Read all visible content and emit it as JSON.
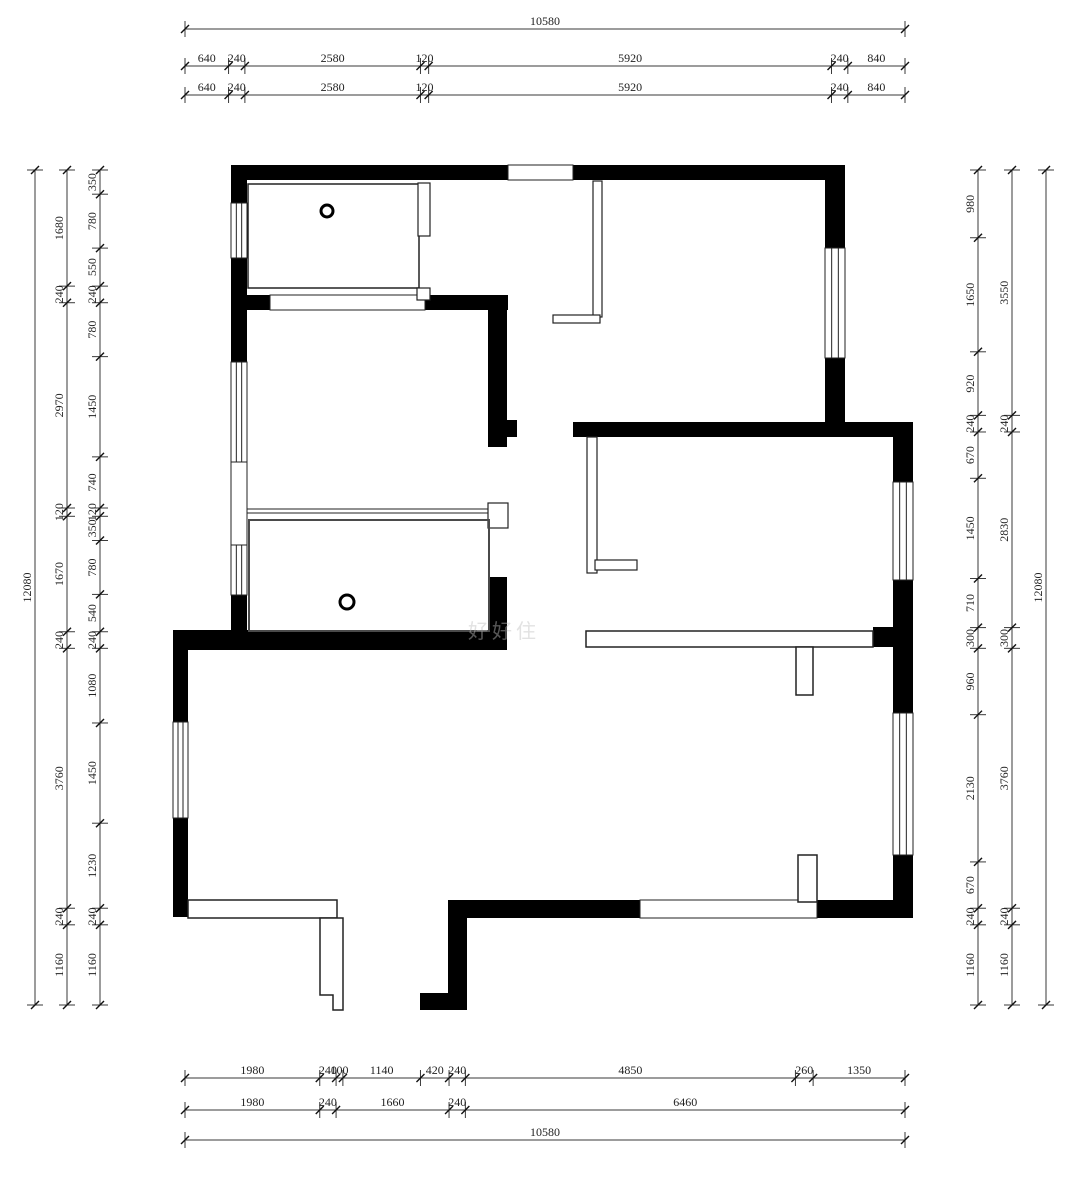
{
  "drawing": {
    "type": "architectural-floor-plan",
    "canvas": {
      "w": 1080,
      "h": 1178
    },
    "colors": {
      "wall": "#000000",
      "dim_line": "#3a3a3a",
      "dim_text": "#222222",
      "thin_line": "#222222",
      "room_outline": "#4a4a4a",
      "background": "#ffffff"
    },
    "watermark": {
      "text": "好好住"
    },
    "dim_font_size": 12,
    "dim_chains": [
      {
        "id": "top-overall",
        "orientation": "h",
        "line": 29,
        "start": 185,
        "end": 905,
        "segments": [
          10580
        ]
      },
      {
        "id": "top-row-1",
        "orientation": "h",
        "line": 66,
        "start": 185,
        "end": 905,
        "segments": [
          640,
          240,
          2580,
          120,
          5920,
          240,
          840
        ]
      },
      {
        "id": "top-row-2",
        "orientation": "h",
        "line": 95,
        "start": 185,
        "end": 905,
        "segments": [
          640,
          240,
          2580,
          120,
          5920,
          240,
          840
        ]
      },
      {
        "id": "left-outer",
        "orientation": "v",
        "line": 35,
        "start": 170,
        "end": 1005,
        "segments": [
          12080
        ]
      },
      {
        "id": "left-middle",
        "orientation": "v",
        "line": 67,
        "start": 170,
        "end": 1005,
        "segments": [
          1680,
          240,
          2970,
          120,
          1670,
          240,
          3760,
          240,
          1160
        ]
      },
      {
        "id": "left-inner",
        "orientation": "v",
        "line": 100,
        "start": 170,
        "end": 1005,
        "segments": [
          350,
          780,
          550,
          240,
          780,
          1450,
          740,
          120,
          350,
          780,
          540,
          240,
          1080,
          1450,
          1230,
          240,
          1160
        ]
      },
      {
        "id": "right-inner",
        "orientation": "v",
        "line": 978,
        "start": 170,
        "end": 1005,
        "segments": [
          980,
          1650,
          920,
          240,
          670,
          1450,
          710,
          300,
          960,
          2130,
          670,
          240,
          1160
        ]
      },
      {
        "id": "right-middle",
        "orientation": "v",
        "line": 1012,
        "start": 170,
        "end": 1005,
        "segments": [
          3550,
          240,
          2830,
          300,
          3760,
          240,
          1160
        ]
      },
      {
        "id": "right-outer",
        "orientation": "v",
        "line": 1046,
        "start": 170,
        "end": 1005,
        "segments": [
          12080
        ]
      },
      {
        "id": "bottom-row-1",
        "orientation": "h",
        "line": 1078,
        "start": 185,
        "end": 905,
        "segments": [
          1980,
          240,
          100,
          1140,
          420,
          240,
          4850,
          260,
          1350
        ]
      },
      {
        "id": "bottom-row-2",
        "orientation": "h",
        "line": 1110,
        "start": 185,
        "end": 905,
        "segments": [
          1980,
          240,
          1660,
          240,
          6460
        ]
      },
      {
        "id": "bottom-overall",
        "orientation": "h",
        "line": 1140,
        "start": 185,
        "end": 905,
        "segments": [
          10580
        ]
      }
    ],
    "plan": {
      "walls": [
        [
          231,
          165,
          277,
          15
        ],
        [
          573,
          165,
          272,
          15
        ],
        [
          231,
          165,
          16,
          38
        ],
        [
          231,
          258,
          16,
          104
        ],
        [
          231,
          595,
          16,
          55
        ],
        [
          173,
          630,
          15,
          92
        ],
        [
          173,
          818,
          15,
          99
        ],
        [
          173,
          630,
          334,
          20
        ],
        [
          245,
          295,
          25,
          15
        ],
        [
          425,
          295,
          83,
          15
        ],
        [
          488,
          310,
          19,
          137
        ],
        [
          507,
          420,
          10,
          17
        ],
        [
          488,
          577,
          19,
          73
        ],
        [
          825,
          165,
          20,
          83
        ],
        [
          825,
          358,
          20,
          65
        ],
        [
          573,
          422,
          340,
          15
        ],
        [
          893,
          437,
          20,
          45
        ],
        [
          893,
          580,
          20,
          133
        ],
        [
          893,
          855,
          20,
          63
        ],
        [
          873,
          627,
          20,
          20
        ],
        [
          448,
          900,
          192,
          18
        ],
        [
          817,
          900,
          96,
          18
        ],
        [
          448,
          918,
          19,
          92
        ],
        [
          420,
          993,
          28,
          17
        ]
      ],
      "windows": [
        {
          "x": 231,
          "y": 203,
          "w": 16,
          "h": 55,
          "dir": "v"
        },
        {
          "x": 231,
          "y": 362,
          "w": 16,
          "h": 100,
          "dir": "v"
        },
        {
          "x": 231,
          "y": 545,
          "w": 16,
          "h": 50,
          "dir": "v"
        },
        {
          "x": 173,
          "y": 722,
          "w": 15,
          "h": 96,
          "dir": "v"
        },
        {
          "x": 825,
          "y": 248,
          "w": 20,
          "h": 110,
          "dir": "v"
        },
        {
          "x": 893,
          "y": 482,
          "w": 20,
          "h": 98,
          "dir": "v"
        },
        {
          "x": 893,
          "y": 713,
          "w": 20,
          "h": 142,
          "dir": "v"
        }
      ],
      "openings": [
        [
          508,
          165,
          65,
          15
        ],
        [
          640,
          900,
          177,
          18
        ],
        [
          270,
          295,
          155,
          15
        ],
        [
          231,
          462,
          16,
          83
        ]
      ],
      "outlines": [
        {
          "x": 248,
          "y": 184,
          "w": 171,
          "h": 104,
          "fill": "none",
          "stroke": "#222222",
          "sw": 1.5
        },
        {
          "x": 417,
          "y": 288,
          "w": 13,
          "h": 12,
          "fill": "#ffffff",
          "stroke": "#222222",
          "sw": 1.2
        },
        {
          "x": 418,
          "y": 183,
          "w": 12,
          "h": 53,
          "fill": "#ffffff",
          "stroke": "#222222",
          "sw": 1.2
        },
        {
          "x": 593,
          "y": 181,
          "w": 9,
          "h": 136,
          "fill": "#ffffff",
          "stroke": "#222222",
          "sw": 1.2
        },
        {
          "x": 553,
          "y": 315,
          "w": 47,
          "h": 8,
          "fill": "#ffffff",
          "stroke": "#222222",
          "sw": 1.2
        },
        {
          "x": 587,
          "y": 437,
          "w": 10,
          "h": 136,
          "fill": "#ffffff",
          "stroke": "#222222",
          "sw": 1.2
        },
        {
          "x": 595,
          "y": 560,
          "w": 42,
          "h": 10,
          "fill": "#ffffff",
          "stroke": "#222222",
          "sw": 1.2
        },
        {
          "x": 488,
          "y": 503,
          "w": 20,
          "h": 25,
          "fill": "#ffffff",
          "stroke": "#222222",
          "sw": 1.2
        },
        {
          "x": 249,
          "y": 520,
          "w": 240,
          "h": 111,
          "fill": "none",
          "stroke": "#4a4a4a",
          "sw": 2
        },
        {
          "x": 586,
          "y": 631,
          "w": 287,
          "h": 16,
          "fill": "#ffffff",
          "stroke": "#222222",
          "sw": 1.5
        },
        {
          "x": 796,
          "y": 647,
          "w": 17,
          "h": 48,
          "fill": "#ffffff",
          "stroke": "#222222",
          "sw": 1.5
        },
        {
          "x": 798,
          "y": 855,
          "w": 19,
          "h": 47,
          "fill": "#ffffff",
          "stroke": "#222222",
          "sw": 1.5
        },
        {
          "x": 188,
          "y": 900,
          "w": 149,
          "h": 18,
          "fill": "#ffffff",
          "stroke": "#222222",
          "sw": 1.5
        }
      ],
      "polygons": [
        {
          "points": "320,918 343,918 343,1010 333,1010 333,995 320,995",
          "fill": "#ffffff",
          "stroke": "#222222",
          "sw": 1.5
        }
      ],
      "lines": [
        [
          247,
          509,
          488,
          509
        ],
        [
          247,
          513,
          488,
          513
        ]
      ],
      "circles": [
        [
          327,
          211,
          6
        ],
        [
          347,
          602,
          7
        ]
      ]
    }
  }
}
